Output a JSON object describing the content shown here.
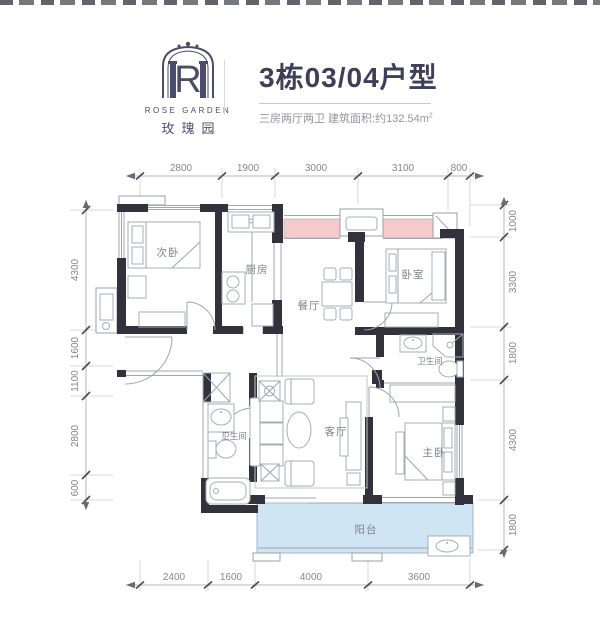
{
  "header": {
    "logo": {
      "letter": "R",
      "name_en": "ROSE GARDEN",
      "name_cn": "玫瑰园"
    },
    "title": "3栋03/04户型",
    "subtitle_main": "三房两厅两卫 建筑面积:约132.54m",
    "subtitle_sup": "2"
  },
  "plan": {
    "rooms": {
      "bedroom2": "次卧",
      "kitchen": "厨房",
      "dining": "餐厅",
      "bedroom3": "卧室",
      "bath_right": "卫生间",
      "bath_left": "卫生间",
      "living": "客厅",
      "master": "主卧",
      "balcony": "阳台"
    },
    "dims": {
      "top": [
        "2800",
        "1900",
        "3000",
        "3100",
        "800"
      ],
      "left": [
        "4300",
        "1600",
        "1100",
        "2800",
        "600"
      ],
      "right": [
        "1000",
        "3300",
        "1800",
        "4300",
        "1800"
      ],
      "bottom": [
        "2400",
        "1600",
        "4000",
        "3600"
      ]
    },
    "colors": {
      "wall": "#32313c",
      "line": "#a0a5ae",
      "bay_window": "#f4caca",
      "balcony": "#cfe5f3",
      "dim_text": "#85878f",
      "title": "#413e59",
      "logo": "#4d4b6b",
      "subtitle": "#94959f"
    }
  }
}
